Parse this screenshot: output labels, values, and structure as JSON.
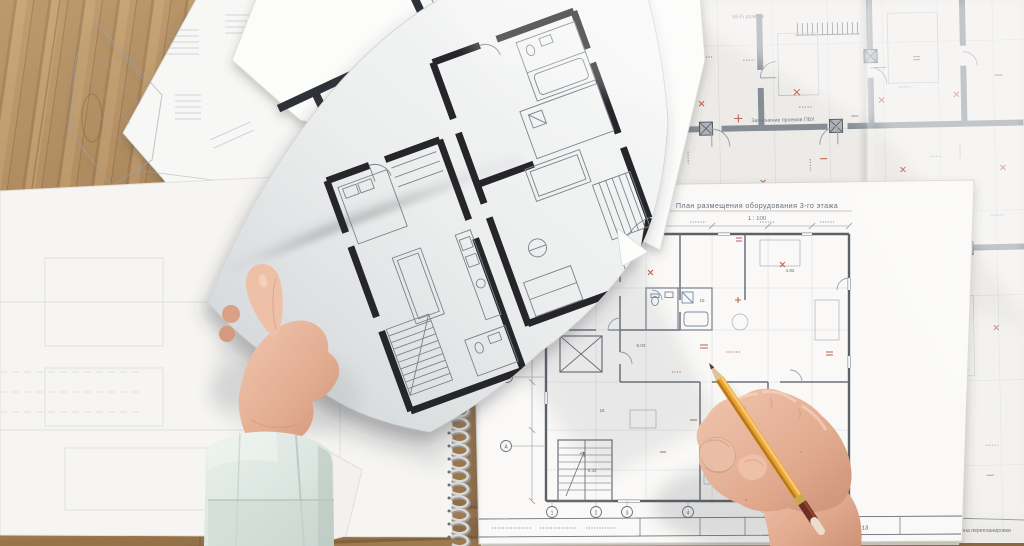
{
  "scene": {
    "alt": "Top-down photo of an architect's wooden desk covered with floor-plan blueprints; a left hand holds a printed black floor plan sheet, a right hand points an orange pencil at a large plan in a spiral-bound pad",
    "colors": {
      "wood": "#b5905f",
      "wood_dark": "#8f6c44",
      "paper_white": "#f6f5f2",
      "notebook_paper": "#faf9f7",
      "blueprint_paper": "#edebe7",
      "plan_ink_black": "#26282c",
      "blueprint_line_gray": "#868d95",
      "annotation_red": "#b0503c",
      "pencil_yellow": "#e8a33c",
      "pencil_band_maroon": "#6d2e23",
      "skin": "#e6b49c",
      "cuff_mint": "#dfe7e3"
    }
  },
  "notebook_plan": {
    "title": "План размещения оборудования 3-го этажа",
    "scale": "1 : 100",
    "sheet_number": "13",
    "title_block_caption": "по объекту",
    "grid_bubbles_bottom": [
      "1",
      "2",
      "3",
      "4"
    ],
    "grid_bubbles_left": [
      "Г",
      "В",
      "Б",
      "А"
    ],
    "room_labels": [
      "8.17",
      "6.03",
      "4.82",
      "15",
      "16",
      "21",
      "45.78",
      "9.33"
    ]
  },
  "right_blueprint": {
    "notes": [
      "Wi-Fi розетка",
      "Заполнение проемов ПВХ",
      "W-1 профиль"
    ],
    "caption": "Зона перепланировки"
  }
}
